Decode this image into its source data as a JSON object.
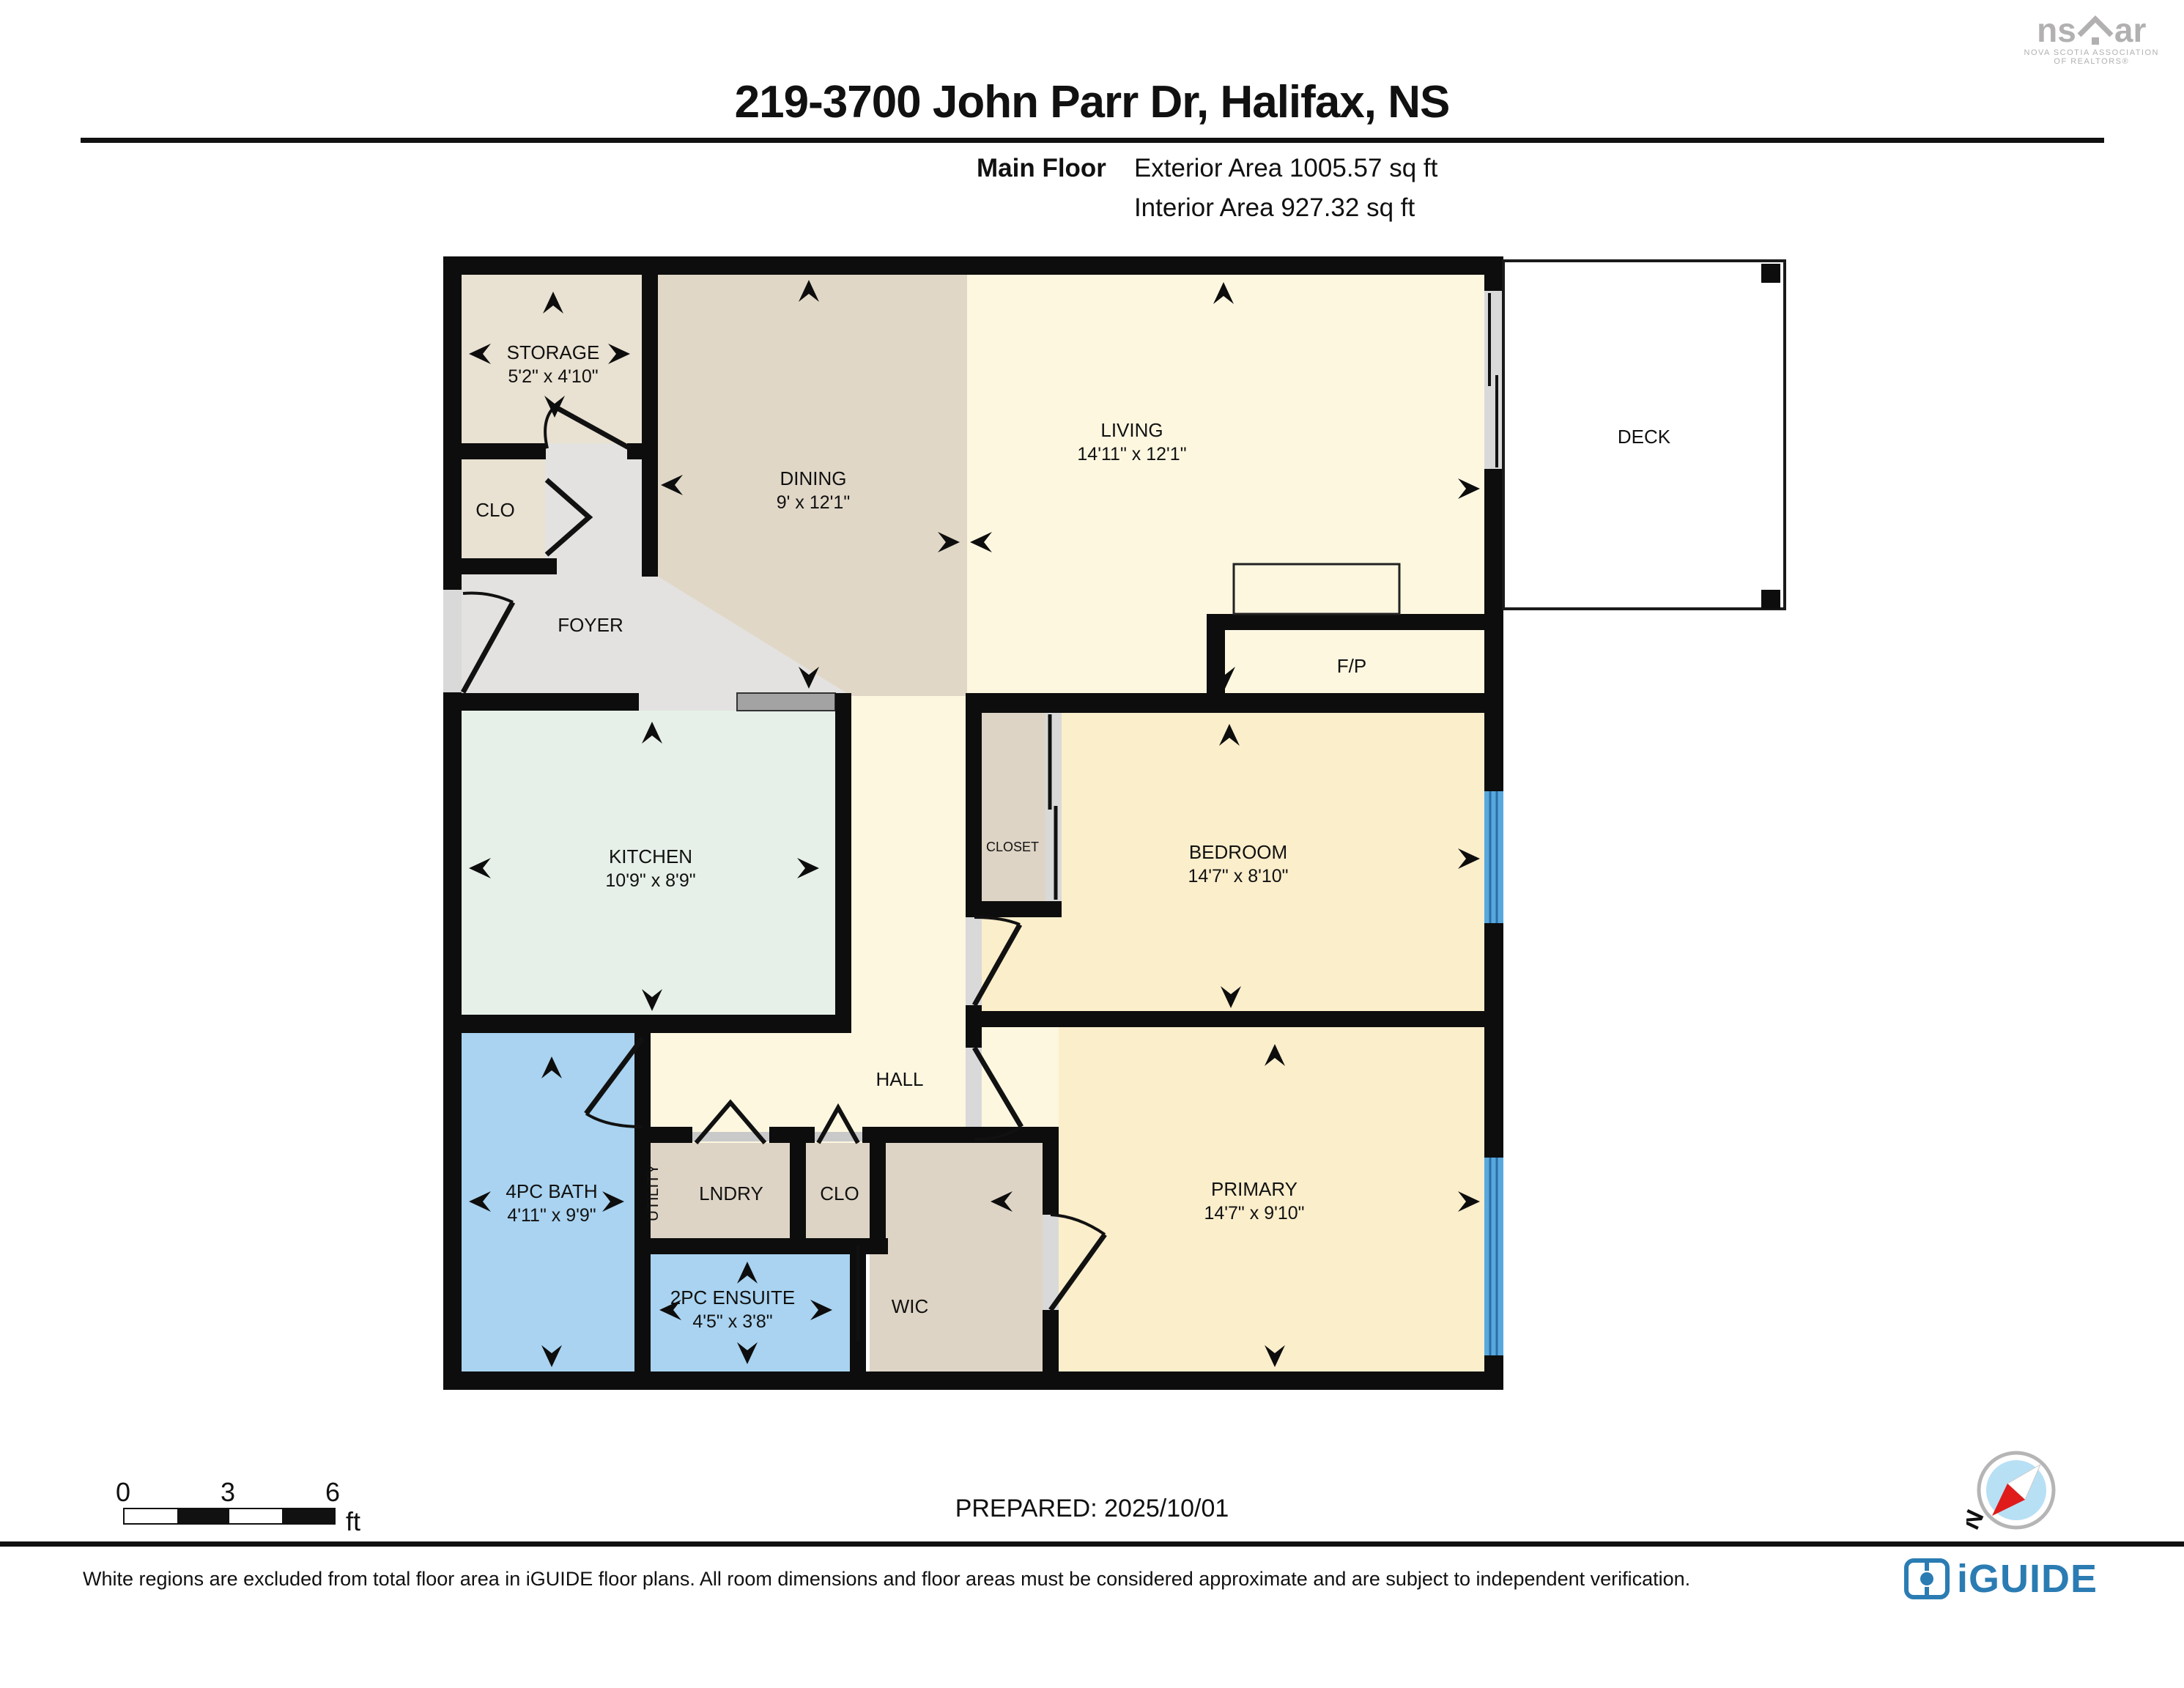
{
  "header": {
    "title": "219-3700 John Parr Dr, Halifax, NS",
    "floor_label": "Main Floor",
    "exterior_area": "Exterior Area 1005.57 sq ft",
    "interior_area": "Interior Area 927.32 sq ft",
    "nsar_logo_left": "ns",
    "nsar_logo_right": "ar",
    "nsar_sub1": "NOVA SCOTIA ASSOCIATION",
    "nsar_sub2": "OF REALTORS®"
  },
  "rooms": {
    "storage": {
      "name": "STORAGE",
      "dims": "5'2\" x 4'10\""
    },
    "clo_entry": {
      "name": "CLO"
    },
    "foyer": {
      "name": "FOYER"
    },
    "dining": {
      "name": "DINING",
      "dims": "9' x 12'1\""
    },
    "living": {
      "name": "LIVING",
      "dims": "14'11\" x 12'1\""
    },
    "deck": {
      "name": "DECK"
    },
    "fireplace": {
      "name": "F/P"
    },
    "kitchen": {
      "name": "KITCHEN",
      "dims": "10'9\" x 8'9\""
    },
    "closet": {
      "name": "CLOSET"
    },
    "bedroom": {
      "name": "BEDROOM",
      "dims": "14'7\" x 8'10\""
    },
    "hall": {
      "name": "HALL"
    },
    "bath": {
      "name": "4PC BATH",
      "dims": "4'11\" x 9'9\""
    },
    "utility": {
      "name": "UTILITY"
    },
    "laundry": {
      "name": "LNDRY"
    },
    "clo_hall": {
      "name": "CLO"
    },
    "ensuite": {
      "name": "2PC ENSUITE",
      "dims": "4'5\" x 3'8\""
    },
    "wic": {
      "name": "WIC"
    },
    "primary": {
      "name": "PRIMARY",
      "dims": "14'7\" x 9'10\""
    }
  },
  "scale_bar": {
    "tick0": "0",
    "tick1": "3",
    "tick2": "6",
    "unit": "ft"
  },
  "prepared": "PREPARED: 2025/10/01",
  "compass": {
    "north_label": "N"
  },
  "footer": {
    "disclaimer": "White regions are excluded from total floor area in iGUIDE floor plans. All room dimensions and floor areas must be considered approximate and are subject to independent verification.",
    "brand": "iGUIDE"
  },
  "colors": {
    "wall": "#0d0d0d",
    "dining_tan": "#e0d7c7",
    "beige_light": "#e9e1d1",
    "cream": "#fdf7e0",
    "cream_yellow": "#fbeecb",
    "kitchen_green": "#e6f0e8",
    "bath_blue": "#a9d3f0",
    "storage_beige": "#ddd4c5",
    "foyer_gray": "#e3e2e0",
    "window_blue": "#58a8dd",
    "brand_blue": "#2b7cb3"
  }
}
